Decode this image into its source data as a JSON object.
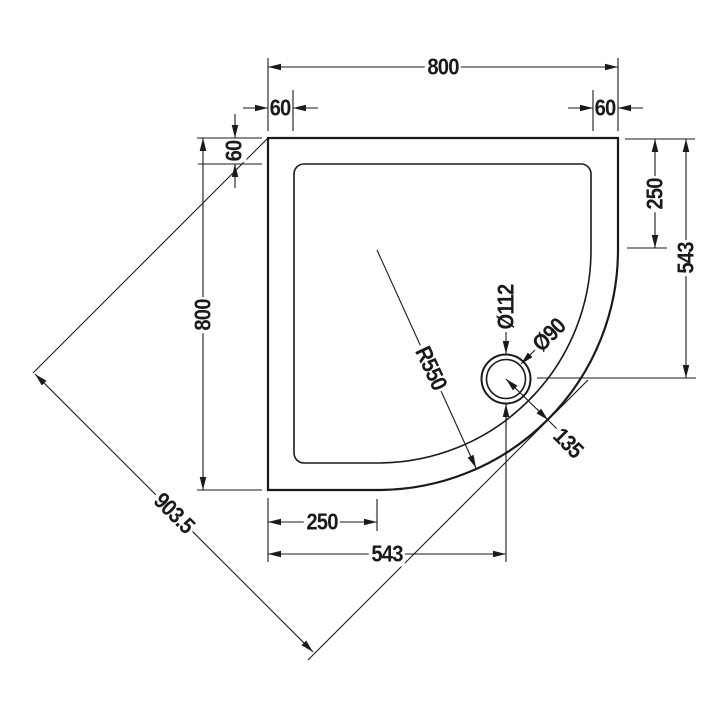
{
  "drawing": {
    "labels": {
      "top_width": "800",
      "top_inset_left": "60",
      "top_inset_right": "60",
      "side_inset_top_left": "60",
      "left_height": "800",
      "right_top_to_curve": "250",
      "right_top_to_drain": "543",
      "bottom_left_to_inner": "250",
      "bottom_left_to_drain": "543",
      "diagonal_width": "903.5",
      "corner_radius": "R550",
      "waste_outer_diameter": "Ø112",
      "waste_inner_diameter": "Ø90",
      "drain_diagonal_offset": "135"
    },
    "colors": {
      "line": "#1a1a1a",
      "background": "#ffffff"
    }
  }
}
